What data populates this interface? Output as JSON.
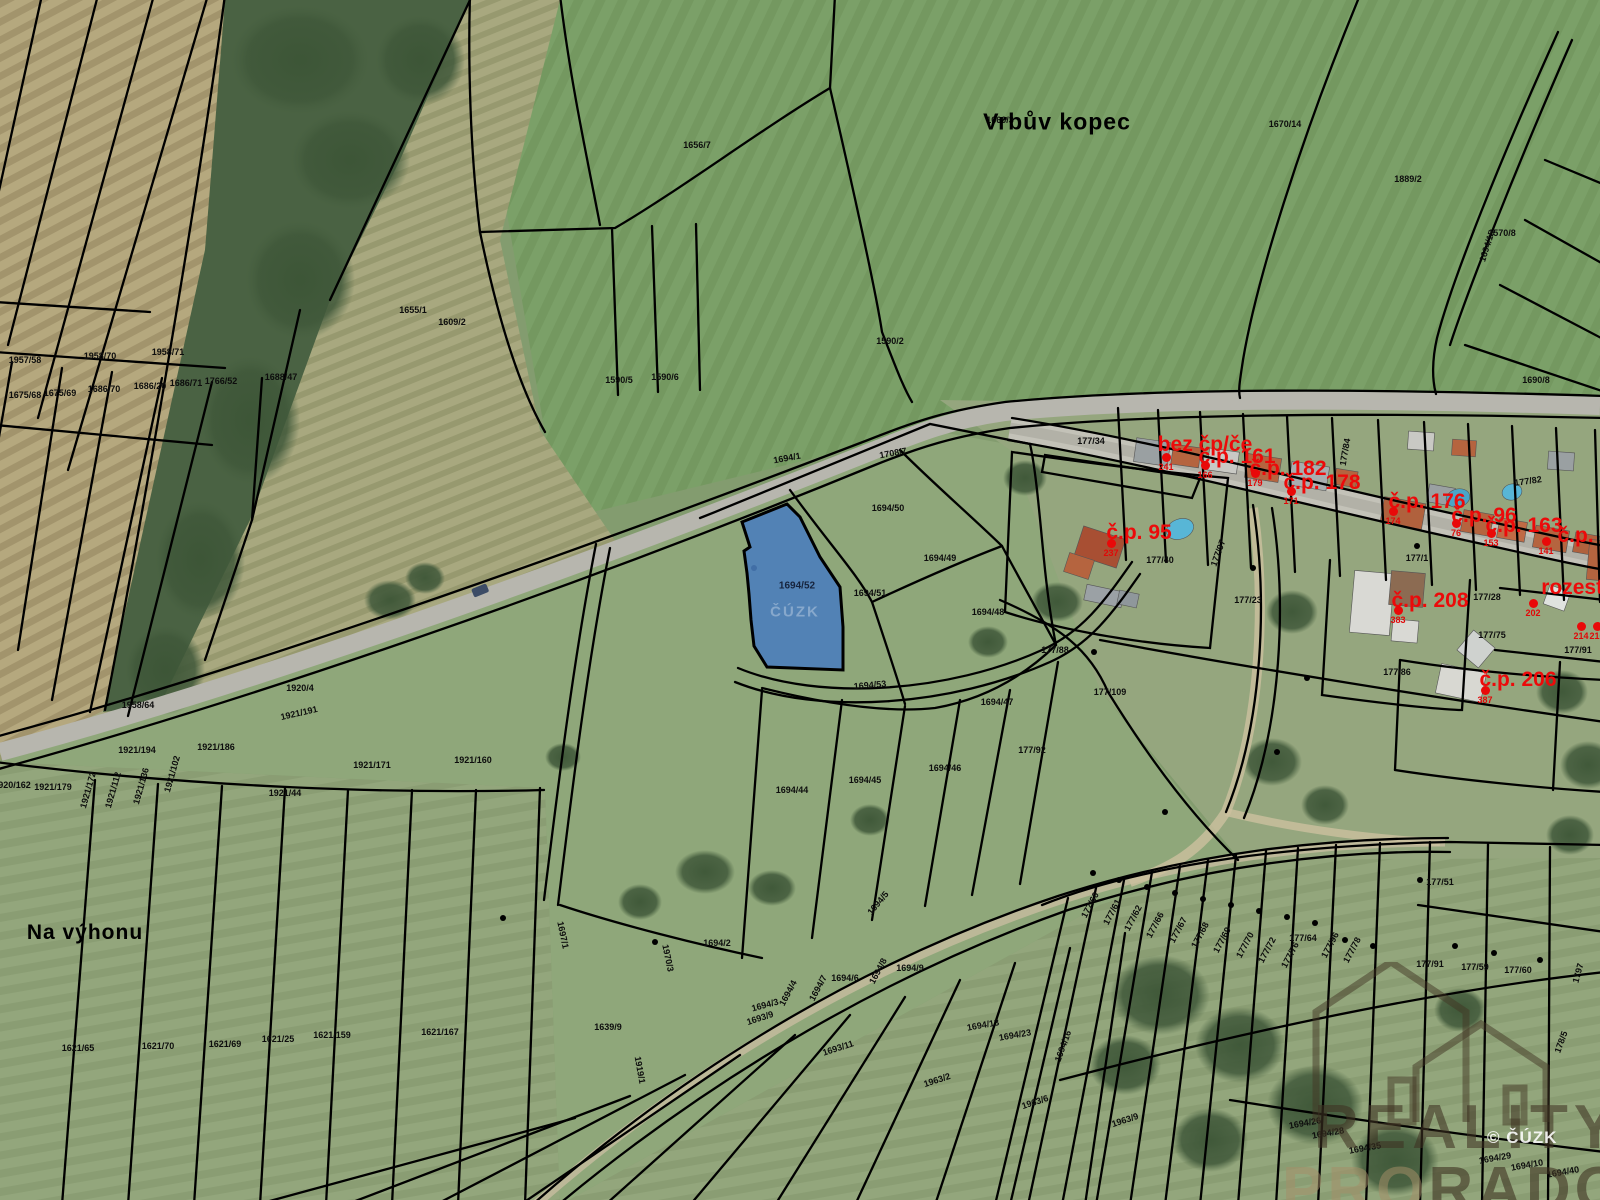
{
  "map": {
    "place_labels": [
      {
        "text": "Vrbův kopec",
        "x": 1057,
        "y": 122,
        "size": 23
      },
      {
        "text": "Na výhonu",
        "x": 85,
        "y": 933,
        "size": 21
      }
    ],
    "highlight": {
      "parcel_number": "1694/52",
      "label_x": 797,
      "label_y": 586,
      "fill_color": "#4a7dbd",
      "ghost_text": "ČÚZK",
      "ghost_x": 795,
      "ghost_y": 612
    },
    "red_labels": [
      {
        "text": "bez čp/če",
        "x": 1205,
        "y": 445
      },
      {
        "text": "č.p. 161",
        "x": 1237,
        "y": 457
      },
      {
        "text": "č.p. 182",
        "x": 1288,
        "y": 469
      },
      {
        "text": "č.p. 178",
        "x": 1322,
        "y": 483
      },
      {
        "text": "č.p. 176",
        "x": 1427,
        "y": 502
      },
      {
        "text": "č.p. 96",
        "x": 1484,
        "y": 516
      },
      {
        "text": "č.p. 163",
        "x": 1524,
        "y": 526
      },
      {
        "text": "č.p. 162",
        "x": 1596,
        "y": 536
      },
      {
        "text": "č.p. 95",
        "x": 1139,
        "y": 533
      },
      {
        "text": "č.p. 208",
        "x": 1430,
        "y": 601
      },
      {
        "text": "rozestav.",
        "x": 1586,
        "y": 588
      },
      {
        "text": "č.p. 206",
        "x": 1518,
        "y": 680
      }
    ],
    "red_points": [
      {
        "x": 1166,
        "y": 457,
        "num": "241"
      },
      {
        "x": 1205,
        "y": 465,
        "num": "166"
      },
      {
        "x": 1255,
        "y": 473,
        "num": "179"
      },
      {
        "x": 1291,
        "y": 491,
        "num": "171"
      },
      {
        "x": 1393,
        "y": 511,
        "num": "174"
      },
      {
        "x": 1456,
        "y": 523,
        "num": "76"
      },
      {
        "x": 1491,
        "y": 533,
        "num": "153"
      },
      {
        "x": 1546,
        "y": 541,
        "num": "141"
      },
      {
        "x": 1111,
        "y": 543,
        "num": "237"
      },
      {
        "x": 1398,
        "y": 610,
        "num": "383"
      },
      {
        "x": 1533,
        "y": 603,
        "num": "202"
      },
      {
        "x": 1485,
        "y": 690,
        "num": "387"
      },
      {
        "x": 1581,
        "y": 626,
        "num": "214"
      },
      {
        "x": 1597,
        "y": 626,
        "num": "216"
      }
    ],
    "parcel_labels": [
      {
        "text": "1656/7",
        "x": 697,
        "y": 145
      },
      {
        "text": "1655/1",
        "x": 413,
        "y": 310
      },
      {
        "text": "1609/2",
        "x": 452,
        "y": 322
      },
      {
        "text": "1590/5",
        "x": 619,
        "y": 380
      },
      {
        "text": "1590/6",
        "x": 665,
        "y": 377
      },
      {
        "text": "1590/2",
        "x": 890,
        "y": 341
      },
      {
        "text": "1660/3",
        "x": 1000,
        "y": 120
      },
      {
        "text": "1670/14",
        "x": 1285,
        "y": 124
      },
      {
        "text": "1889/2",
        "x": 1408,
        "y": 179
      },
      {
        "text": "1694/15",
        "x": 1487,
        "y": 246,
        "rot": -72
      },
      {
        "text": "1570/8",
        "x": 1502,
        "y": 233
      },
      {
        "text": "1690/8",
        "x": 1536,
        "y": 380
      },
      {
        "text": "1675/68",
        "x": 25,
        "y": 395
      },
      {
        "text": "1675/69",
        "x": 60,
        "y": 393
      },
      {
        "text": "1686/70",
        "x": 104,
        "y": 389
      },
      {
        "text": "1686/20",
        "x": 150,
        "y": 386
      },
      {
        "text": "1686/71",
        "x": 186,
        "y": 383
      },
      {
        "text": "1766/52",
        "x": 221,
        "y": 381
      },
      {
        "text": "1688/47",
        "x": 281,
        "y": 377
      },
      {
        "text": "1920/4",
        "x": 300,
        "y": 688
      },
      {
        "text": "1921/191",
        "x": 299,
        "y": 713,
        "rot": -13
      },
      {
        "text": "1958/64",
        "x": 138,
        "y": 705
      },
      {
        "text": "1921/194",
        "x": 137,
        "y": 750
      },
      {
        "text": "1921/186",
        "x": 216,
        "y": 747
      },
      {
        "text": "1921/171",
        "x": 372,
        "y": 765
      },
      {
        "text": "1921/160",
        "x": 473,
        "y": 760
      },
      {
        "text": "1921/44",
        "x": 285,
        "y": 793
      },
      {
        "text": "1921/179",
        "x": 53,
        "y": 787
      },
      {
        "text": "1920/162",
        "x": 12,
        "y": 785
      },
      {
        "text": "1921/172",
        "x": 88,
        "y": 790,
        "rot": -74
      },
      {
        "text": "1921/112",
        "x": 113,
        "y": 790,
        "rot": -74
      },
      {
        "text": "1921/136",
        "x": 141,
        "y": 786,
        "rot": -74
      },
      {
        "text": "1921/102",
        "x": 172,
        "y": 774,
        "rot": -74
      },
      {
        "text": "1621/65",
        "x": 78,
        "y": 1048
      },
      {
        "text": "1621/70",
        "x": 158,
        "y": 1046
      },
      {
        "text": "1621/69",
        "x": 225,
        "y": 1044
      },
      {
        "text": "1621/25",
        "x": 278,
        "y": 1039
      },
      {
        "text": "1621/159",
        "x": 332,
        "y": 1035
      },
      {
        "text": "1621/167",
        "x": 440,
        "y": 1032
      },
      {
        "text": "1694/1",
        "x": 787,
        "y": 458,
        "rot": -10
      },
      {
        "text": "1708/7",
        "x": 893,
        "y": 453,
        "rot": -10
      },
      {
        "text": "1694/50",
        "x": 888,
        "y": 508
      },
      {
        "text": "1694/49",
        "x": 940,
        "y": 558
      },
      {
        "text": "1694/51",
        "x": 870,
        "y": 593
      },
      {
        "text": "1694/48",
        "x": 988,
        "y": 612
      },
      {
        "text": "1694/53",
        "x": 870,
        "y": 685,
        "rot": -5
      },
      {
        "text": "1694/47",
        "x": 997,
        "y": 702
      },
      {
        "text": "1694/46",
        "x": 945,
        "y": 768
      },
      {
        "text": "1694/45",
        "x": 865,
        "y": 780
      },
      {
        "text": "1694/44",
        "x": 792,
        "y": 790
      },
      {
        "text": "177/88",
        "x": 1055,
        "y": 650
      },
      {
        "text": "177/92",
        "x": 1032,
        "y": 750
      },
      {
        "text": "177/34",
        "x": 1091,
        "y": 441
      },
      {
        "text": "177/84",
        "x": 1345,
        "y": 452,
        "rot": -80
      },
      {
        "text": "177/82",
        "x": 1528,
        "y": 481,
        "rot": -8
      },
      {
        "text": "177/40",
        "x": 1160,
        "y": 560
      },
      {
        "text": "177/97",
        "x": 1218,
        "y": 553,
        "rot": -70
      },
      {
        "text": "177/23",
        "x": 1248,
        "y": 600
      },
      {
        "text": "177/1",
        "x": 1417,
        "y": 558
      },
      {
        "text": "177/28",
        "x": 1487,
        "y": 597
      },
      {
        "text": "177/75",
        "x": 1492,
        "y": 635
      },
      {
        "text": "177/91",
        "x": 1578,
        "y": 650
      },
      {
        "text": "177/86",
        "x": 1397,
        "y": 672
      },
      {
        "text": "177/109",
        "x": 1110,
        "y": 692
      },
      {
        "text": "177/60",
        "x": 1090,
        "y": 905,
        "rot": -62
      },
      {
        "text": "177/61",
        "x": 1112,
        "y": 912,
        "rot": -62
      },
      {
        "text": "177/62",
        "x": 1133,
        "y": 918,
        "rot": -62
      },
      {
        "text": "177/66",
        "x": 1155,
        "y": 925,
        "rot": -62
      },
      {
        "text": "177/67",
        "x": 1178,
        "y": 930,
        "rot": -62
      },
      {
        "text": "177/68",
        "x": 1200,
        "y": 935,
        "rot": -62
      },
      {
        "text": "177/69",
        "x": 1222,
        "y": 940,
        "rot": -62
      },
      {
        "text": "177/70",
        "x": 1245,
        "y": 945,
        "rot": -62
      },
      {
        "text": "177/72",
        "x": 1267,
        "y": 950,
        "rot": -62
      },
      {
        "text": "177/76",
        "x": 1290,
        "y": 955,
        "rot": -62
      },
      {
        "text": "177/64",
        "x": 1303,
        "y": 938
      },
      {
        "text": "177/96",
        "x": 1330,
        "y": 945,
        "rot": -62
      },
      {
        "text": "177/78",
        "x": 1352,
        "y": 950,
        "rot": -62
      },
      {
        "text": "177/51",
        "x": 1440,
        "y": 882
      },
      {
        "text": "177/59",
        "x": 1475,
        "y": 967
      },
      {
        "text": "177/60",
        "x": 1518,
        "y": 970
      },
      {
        "text": "1797",
        "x": 1578,
        "y": 973,
        "rot": -75
      },
      {
        "text": "178/5",
        "x": 1561,
        "y": 1042,
        "rot": -70
      },
      {
        "text": "177/91",
        "x": 1430,
        "y": 964
      },
      {
        "text": "1694/26",
        "x": 1305,
        "y": 1123,
        "rot": -10
      },
      {
        "text": "1694/28",
        "x": 1328,
        "y": 1133,
        "rot": -10
      },
      {
        "text": "1694/35",
        "x": 1365,
        "y": 1148,
        "rot": -10
      },
      {
        "text": "1694/29",
        "x": 1495,
        "y": 1158,
        "rot": -10
      },
      {
        "text": "1694/10",
        "x": 1527,
        "y": 1165,
        "rot": -10
      },
      {
        "text": "1694/40",
        "x": 1563,
        "y": 1172,
        "rot": -10
      },
      {
        "text": "1639/9",
        "x": 608,
        "y": 1027
      },
      {
        "text": "1919/1",
        "x": 640,
        "y": 1070,
        "rot": 80
      },
      {
        "text": "1697/1",
        "x": 563,
        "y": 935,
        "rot": 78
      },
      {
        "text": "1970/3",
        "x": 668,
        "y": 958,
        "rot": 78
      },
      {
        "text": "1694/2",
        "x": 717,
        "y": 943
      },
      {
        "text": "1694/3",
        "x": 765,
        "y": 1005,
        "rot": -15
      },
      {
        "text": "1694/4",
        "x": 788,
        "y": 993,
        "rot": -62
      },
      {
        "text": "1694/7",
        "x": 818,
        "y": 988,
        "rot": -62
      },
      {
        "text": "1694/6",
        "x": 845,
        "y": 978
      },
      {
        "text": "1694/8",
        "x": 878,
        "y": 971,
        "rot": -62
      },
      {
        "text": "1694/9",
        "x": 910,
        "y": 968
      },
      {
        "text": "1694/5",
        "x": 878,
        "y": 903,
        "rot": -50
      },
      {
        "text": "1693/9",
        "x": 760,
        "y": 1018,
        "rot": -18
      },
      {
        "text": "1693/11",
        "x": 838,
        "y": 1048,
        "rot": -18
      },
      {
        "text": "1963/2",
        "x": 937,
        "y": 1080,
        "rot": -18
      },
      {
        "text": "1963/6",
        "x": 1035,
        "y": 1102,
        "rot": -18
      },
      {
        "text": "1963/9",
        "x": 1125,
        "y": 1120,
        "rot": -18
      },
      {
        "text": "1694/13",
        "x": 983,
        "y": 1025,
        "rot": -10
      },
      {
        "text": "1694/23",
        "x": 1015,
        "y": 1035,
        "rot": -10
      },
      {
        "text": "1694/16",
        "x": 1063,
        "y": 1046,
        "rot": -70
      },
      {
        "text": "1957/58",
        "x": 25,
        "y": 360
      },
      {
        "text": "1958/70",
        "x": 100,
        "y": 356
      },
      {
        "text": "1958/71",
        "x": 168,
        "y": 352
      }
    ],
    "watermark": {
      "line1": "REALITY",
      "line2_light": "PRO",
      "line2_dark": "RADOST",
      "copyright": "© ČÚZK"
    }
  }
}
